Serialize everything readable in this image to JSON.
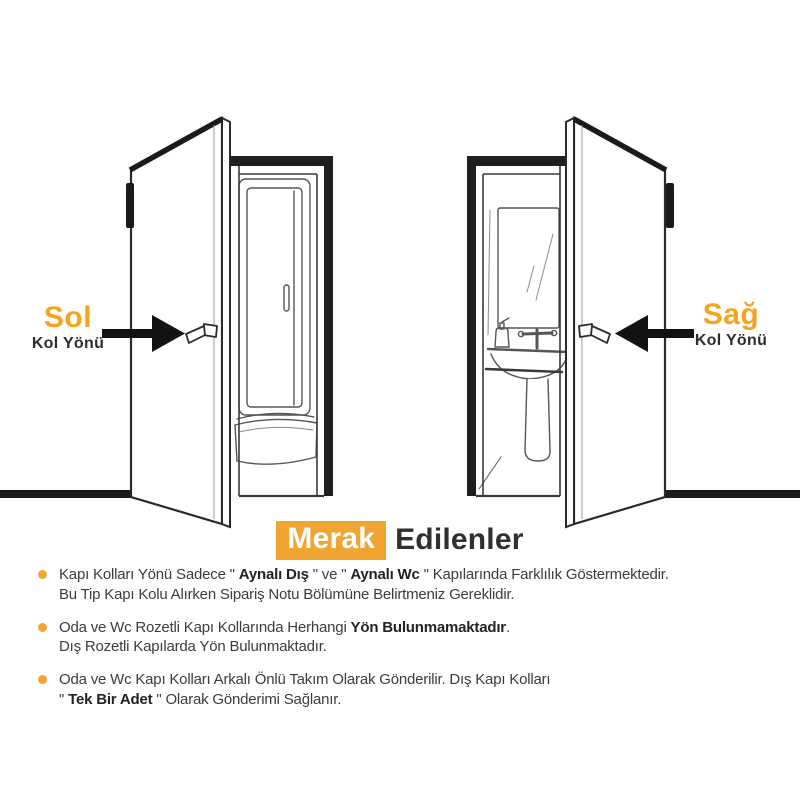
{
  "page": {
    "background": "#ffffff"
  },
  "colors": {
    "accent_orange": "#F0A432",
    "label_orange": "#F5A41F",
    "title_dark": "#2F2F2F",
    "body_text": "#3C3C3C",
    "line_art": "#2B2B2B"
  },
  "left_door": {
    "direction_label": "Sol",
    "sub_label": "Kol Yönü",
    "arrow_icon": "right-arrow",
    "interior": "shower-cabin"
  },
  "right_door": {
    "direction_label": "Sağ",
    "sub_label": "Kol Yönü",
    "arrow_icon": "left-arrow",
    "interior": "bathroom-sink-mirror"
  },
  "faq": {
    "title_highlight": "Merak",
    "title_rest": "Edilenler",
    "items": [
      {
        "lines": [
          {
            "segments": [
              {
                "t": "Kapı Kolları Yönü Sadece \" ",
                "b": false
              },
              {
                "t": "Aynalı Dış",
                "b": true
              },
              {
                "t": " \" ve \" ",
                "b": false
              },
              {
                "t": "Aynalı Wc",
                "b": true
              },
              {
                "t": " \" Kapılarında Farklılık Göstermektedir.",
                "b": false
              }
            ]
          },
          {
            "segments": [
              {
                "t": "Bu Tip Kapı Kolu Alırken Sipariş Notu Bölümüne Belirtmeniz Gereklidir.",
                "b": false
              }
            ]
          }
        ]
      },
      {
        "lines": [
          {
            "segments": [
              {
                "t": "Oda ve Wc Rozetli Kapı Kollarında Herhangi ",
                "b": false
              },
              {
                "t": "Yön Bulunmamaktadır",
                "b": true
              },
              {
                "t": ".",
                "b": false
              }
            ]
          },
          {
            "segments": [
              {
                "t": "Dış Rozetli Kapılarda Yön Bulunmaktadır.",
                "b": false
              }
            ]
          }
        ]
      },
      {
        "lines": [
          {
            "segments": [
              {
                "t": "Oda ve Wc Kapı Kolları Arkalı Önlü Takım Olarak Gönderilir. Dış Kapı Kolları",
                "b": false
              }
            ]
          },
          {
            "segments": [
              {
                "t": "\" ",
                "b": false
              },
              {
                "t": "Tek Bir Adet",
                "b": true
              },
              {
                "t": " \" Olarak Gönderimi Sağlanır.",
                "b": false
              }
            ]
          }
        ]
      }
    ]
  }
}
